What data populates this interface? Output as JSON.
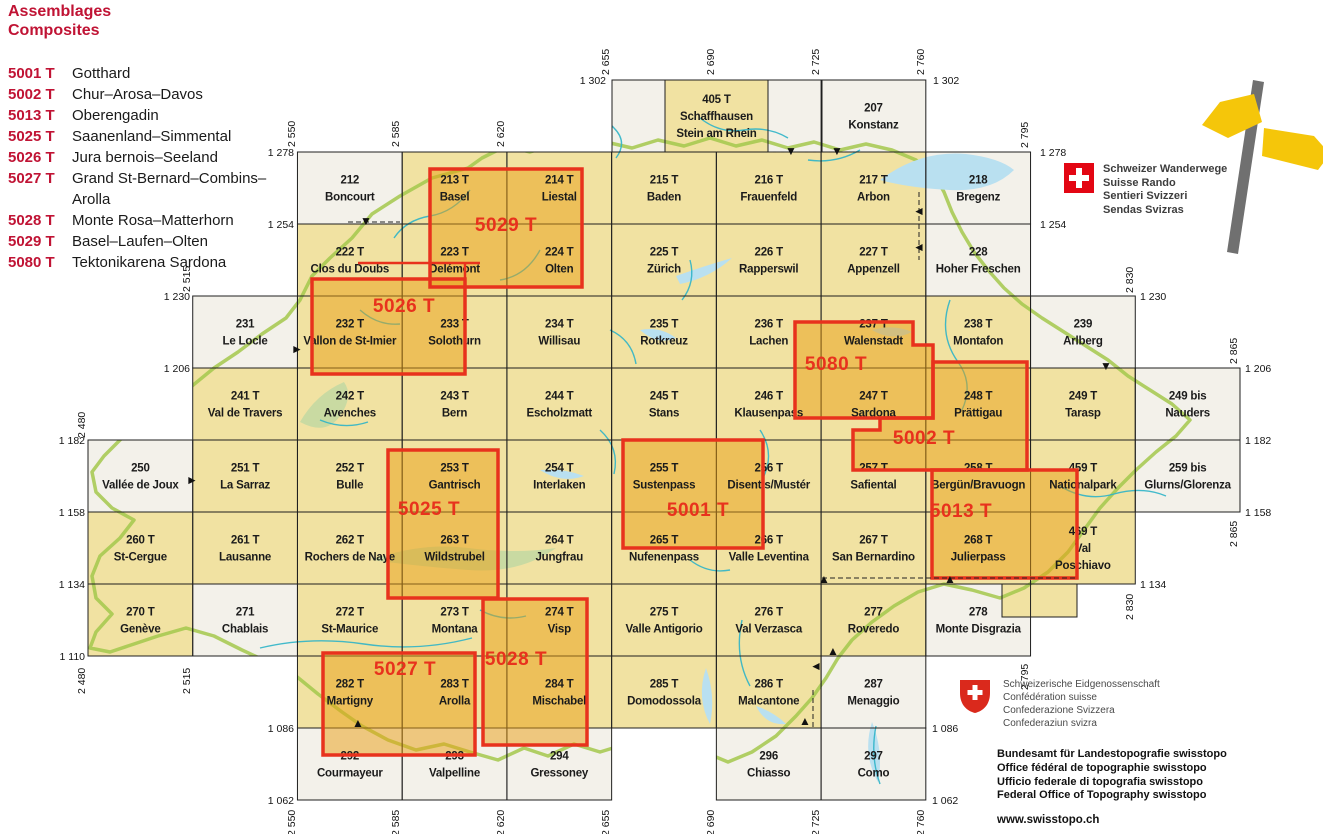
{
  "legend": {
    "title1": "Assemblages",
    "title2": "Composites",
    "items": [
      {
        "code": "5001 T",
        "name": "Gotthard"
      },
      {
        "code": "5002 T",
        "name": "Chur–Arosa–Davos"
      },
      {
        "code": "5013 T",
        "name": "Oberengadin"
      },
      {
        "code": "5025 T",
        "name": "Saanenland–Simmental"
      },
      {
        "code": "5026 T",
        "name": "Jura bernois–Seeland"
      },
      {
        "code": "5027 T",
        "name": "Grand St-Bernard–Combins– Arolla"
      },
      {
        "code": "5028 T",
        "name": "Monte Rosa–Matterhorn"
      },
      {
        "code": "5029 T",
        "name": "Basel–Laufen–Olten"
      },
      {
        "code": "5080 T",
        "name": "Tektonikarena Sardona"
      }
    ]
  },
  "wanderwege": {
    "lines": [
      "Schweizer Wanderwege",
      "Suisse Rando",
      "Sentieri Svizzeri",
      "Sendas Svizras"
    ]
  },
  "footer": {
    "confed_lines": [
      "Schweizerische Eidgenossenschaft",
      "Confédération suisse",
      "Confederazione Svizzera",
      "Confederaziun svizra"
    ],
    "office_lines": [
      "Bundesamt für Landestopografie swisstopo",
      "Office fédéral de topographie swisstopo",
      "Ufficio federale di topografia swisstopo",
      "Federal Office of Topography swisstopo"
    ],
    "website": "www.swisstopo.ch"
  },
  "map": {
    "colors": {
      "plain": "#f1e2a2",
      "foreign": "#f3f1ea",
      "highlight_fill": "rgba(234,158,18,0.5)",
      "composite_red": "#e8321d",
      "legend_red": "#c01334",
      "grid_line": "#1f1f1f",
      "river": "#2fb4c8",
      "border_trail": "#a3c84c",
      "lake_blue": "#b9e0f0",
      "lake_green": "#c9daa2"
    },
    "cells": [
      {
        "n": "",
        "m": [],
        "px": [
          612,
          80,
          53,
          72
        ],
        "t": "f"
      },
      {
        "n": "405 T",
        "m": [
          "Schaffhausen",
          "Stein am Rhein"
        ],
        "px": [
          665,
          80,
          103,
          72
        ],
        "t": "p"
      },
      {
        "n": "",
        "m": [],
        "px": [
          768,
          80,
          54,
          72
        ],
        "t": "f"
      },
      {
        "n": "207",
        "m": [
          "Konstanz"
        ],
        "e": 2725,
        "no": 1302,
        "t": "f"
      },
      {
        "n": "212",
        "m": [
          "Boncourt"
        ],
        "e": 2550,
        "no": 1278,
        "t": "f"
      },
      {
        "n": "213 T",
        "m": [
          "Basel"
        ],
        "e": 2585,
        "no": 1278,
        "t": "p"
      },
      {
        "n": "214 T",
        "m": [
          "Liestal"
        ],
        "e": 2620,
        "no": 1278,
        "t": "p"
      },
      {
        "n": "215 T",
        "m": [
          "Baden"
        ],
        "e": 2655,
        "no": 1278,
        "t": "p"
      },
      {
        "n": "216 T",
        "m": [
          "Frauenfeld"
        ],
        "e": 2690,
        "no": 1278,
        "t": "p"
      },
      {
        "n": "217 T",
        "m": [
          "Arbon"
        ],
        "e": 2725,
        "no": 1278,
        "t": "p"
      },
      {
        "n": "218",
        "m": [
          "Bregenz"
        ],
        "e": 2760,
        "no": 1278,
        "t": "f"
      },
      {
        "n": "222 T",
        "m": [
          "Clos du Doubs"
        ],
        "e": 2550,
        "no": 1254,
        "t": "p"
      },
      {
        "n": "223 T",
        "m": [
          "Delémont"
        ],
        "e": 2585,
        "no": 1254,
        "t": "p"
      },
      {
        "n": "224 T",
        "m": [
          "Olten"
        ],
        "e": 2620,
        "no": 1254,
        "t": "p"
      },
      {
        "n": "225 T",
        "m": [
          "Zürich"
        ],
        "e": 2655,
        "no": 1254,
        "t": "p"
      },
      {
        "n": "226 T",
        "m": [
          "Rapperswil"
        ],
        "e": 2690,
        "no": 1254,
        "t": "p"
      },
      {
        "n": "227 T",
        "m": [
          "Appenzell"
        ],
        "e": 2725,
        "no": 1254,
        "t": "p"
      },
      {
        "n": "228",
        "m": [
          "Hoher Freschen"
        ],
        "e": 2760,
        "no": 1254,
        "t": "f"
      },
      {
        "n": "231",
        "m": [
          "Le Locle"
        ],
        "e": 2515,
        "no": 1230,
        "t": "f"
      },
      {
        "n": "232 T",
        "m": [
          "Vallon de St-Imier"
        ],
        "e": 2550,
        "no": 1230,
        "t": "p"
      },
      {
        "n": "233 T",
        "m": [
          "Solothurn"
        ],
        "e": 2585,
        "no": 1230,
        "t": "p"
      },
      {
        "n": "234 T",
        "m": [
          "Willisau"
        ],
        "e": 2620,
        "no": 1230,
        "t": "p"
      },
      {
        "n": "235 T",
        "m": [
          "Rotkreuz"
        ],
        "e": 2655,
        "no": 1230,
        "t": "p"
      },
      {
        "n": "236 T",
        "m": [
          "Lachen"
        ],
        "e": 2690,
        "no": 1230,
        "t": "p"
      },
      {
        "n": "237 T",
        "m": [
          "Walenstadt"
        ],
        "e": 2725,
        "no": 1230,
        "t": "p"
      },
      {
        "n": "238 T",
        "m": [
          "Montafon"
        ],
        "e": 2760,
        "no": 1230,
        "t": "p"
      },
      {
        "n": "239",
        "m": [
          "Arlberg"
        ],
        "e": 2795,
        "no": 1230,
        "t": "f"
      },
      {
        "n": "241 T",
        "m": [
          "Val de Travers"
        ],
        "e": 2515,
        "no": 1206,
        "t": "p"
      },
      {
        "n": "242 T",
        "m": [
          "Avenches"
        ],
        "e": 2550,
        "no": 1206,
        "t": "p"
      },
      {
        "n": "243 T",
        "m": [
          "Bern"
        ],
        "e": 2585,
        "no": 1206,
        "t": "p"
      },
      {
        "n": "244 T",
        "m": [
          "Escholzmatt"
        ],
        "e": 2620,
        "no": 1206,
        "t": "p"
      },
      {
        "n": "245 T",
        "m": [
          "Stans"
        ],
        "e": 2655,
        "no": 1206,
        "t": "p"
      },
      {
        "n": "246 T",
        "m": [
          "Klausenpass"
        ],
        "e": 2690,
        "no": 1206,
        "t": "p"
      },
      {
        "n": "247 T",
        "m": [
          "Sardona"
        ],
        "e": 2725,
        "no": 1206,
        "t": "p"
      },
      {
        "n": "248 T",
        "m": [
          "Prättigau"
        ],
        "e": 2760,
        "no": 1206,
        "t": "p"
      },
      {
        "n": "249 T",
        "m": [
          "Tarasp"
        ],
        "e": 2795,
        "no": 1206,
        "t": "p"
      },
      {
        "n": "249 bis",
        "m": [
          "Nauders"
        ],
        "e": 2830,
        "no": 1206,
        "t": "f"
      },
      {
        "n": "250",
        "m": [
          "Vallée de Joux"
        ],
        "e": 2480,
        "no": 1182,
        "t": "f"
      },
      {
        "n": "251 T",
        "m": [
          "La Sarraz"
        ],
        "e": 2515,
        "no": 1182,
        "t": "p"
      },
      {
        "n": "252 T",
        "m": [
          "Bulle"
        ],
        "e": 2550,
        "no": 1182,
        "t": "p"
      },
      {
        "n": "253 T",
        "m": [
          "Gantrisch"
        ],
        "e": 2585,
        "no": 1182,
        "t": "p"
      },
      {
        "n": "254 T",
        "m": [
          "Interlaken"
        ],
        "e": 2620,
        "no": 1182,
        "t": "p"
      },
      {
        "n": "255 T",
        "m": [
          "Sustenpass"
        ],
        "e": 2655,
        "no": 1182,
        "t": "p"
      },
      {
        "n": "256 T",
        "m": [
          "Disentis/Mustér"
        ],
        "e": 2690,
        "no": 1182,
        "t": "p"
      },
      {
        "n": "257 T",
        "m": [
          "Safiental"
        ],
        "e": 2725,
        "no": 1182,
        "t": "p"
      },
      {
        "n": "258 T",
        "m": [
          "Bergün/Bravuogn"
        ],
        "e": 2760,
        "no": 1182,
        "t": "p"
      },
      {
        "n": "459 T",
        "m": [
          "Nationalpark"
        ],
        "e": 2795,
        "no": 1182,
        "t": "p"
      },
      {
        "n": "259 bis",
        "m": [
          "Glurns/Glorenza"
        ],
        "e": 2830,
        "no": 1182,
        "t": "f"
      },
      {
        "n": "260 T",
        "m": [
          "St-Cergue"
        ],
        "e": 2480,
        "no": 1158,
        "t": "p"
      },
      {
        "n": "261 T",
        "m": [
          "Lausanne"
        ],
        "e": 2515,
        "no": 1158,
        "t": "p"
      },
      {
        "n": "262 T",
        "m": [
          "Rochers de Naye"
        ],
        "e": 2550,
        "no": 1158,
        "t": "p"
      },
      {
        "n": "263 T",
        "m": [
          "Wildstrubel"
        ],
        "e": 2585,
        "no": 1158,
        "t": "p"
      },
      {
        "n": "264 T",
        "m": [
          "Jungfrau"
        ],
        "e": 2620,
        "no": 1158,
        "t": "p"
      },
      {
        "n": "265 T",
        "m": [
          "Nufenenpass"
        ],
        "e": 2655,
        "no": 1158,
        "t": "p"
      },
      {
        "n": "266 T",
        "m": [
          "Valle Leventina"
        ],
        "e": 2690,
        "no": 1158,
        "t": "p"
      },
      {
        "n": "267 T",
        "m": [
          "San Bernardino"
        ],
        "e": 2725,
        "no": 1158,
        "t": "p"
      },
      {
        "n": "268 T",
        "m": [
          "Julierpass"
        ],
        "e": 2760,
        "no": 1158,
        "t": "p"
      },
      {
        "n": "469 T",
        "m": [
          "Val",
          "Poschiavo"
        ],
        "e": 2795,
        "no": 1158,
        "t": "p"
      },
      {
        "n": "270 T",
        "m": [
          "Genève"
        ],
        "e": 2480,
        "no": 1134,
        "t": "p"
      },
      {
        "n": "271",
        "m": [
          "Chablais"
        ],
        "e": 2515,
        "no": 1134,
        "t": "f"
      },
      {
        "n": "272 T",
        "m": [
          "St-Maurice"
        ],
        "e": 2550,
        "no": 1134,
        "t": "p"
      },
      {
        "n": "273 T",
        "m": [
          "Montana"
        ],
        "e": 2585,
        "no": 1134,
        "t": "p"
      },
      {
        "n": "274 T",
        "m": [
          "Visp"
        ],
        "e": 2620,
        "no": 1134,
        "t": "p"
      },
      {
        "n": "275 T",
        "m": [
          "Valle Antigorio"
        ],
        "e": 2655,
        "no": 1134,
        "t": "p"
      },
      {
        "n": "276 T",
        "m": [
          "Val Verzasca"
        ],
        "e": 2690,
        "no": 1134,
        "t": "p"
      },
      {
        "n": "277",
        "m": [
          "Roveredo"
        ],
        "e": 2725,
        "no": 1134,
        "t": "p"
      },
      {
        "n": "278",
        "m": [
          "Monte Disgrazia"
        ],
        "e": 2760,
        "no": 1134,
        "t": "f"
      },
      {
        "n": "282 T",
        "m": [
          "Martigny"
        ],
        "e": 2550,
        "no": 1110,
        "t": "p"
      },
      {
        "n": "283 T",
        "m": [
          "Arolla"
        ],
        "e": 2585,
        "no": 1110,
        "t": "p"
      },
      {
        "n": "284 T",
        "m": [
          "Mischabel"
        ],
        "e": 2620,
        "no": 1110,
        "t": "p"
      },
      {
        "n": "285 T",
        "m": [
          "Domodossola"
        ],
        "e": 2655,
        "no": 1110,
        "t": "p"
      },
      {
        "n": "286 T",
        "m": [
          "Malcantone"
        ],
        "e": 2690,
        "no": 1110,
        "t": "p"
      },
      {
        "n": "287",
        "m": [
          "Menaggio"
        ],
        "e": 2725,
        "no": 1110,
        "t": "f"
      },
      {
        "n": "292",
        "m": [
          "Courmayeur"
        ],
        "e": 2550,
        "no": 1086,
        "t": "f"
      },
      {
        "n": "293",
        "m": [
          "Valpelline"
        ],
        "e": 2585,
        "no": 1086,
        "t": "f"
      },
      {
        "n": "294",
        "m": [
          "Gressoney"
        ],
        "e": 2620,
        "no": 1086,
        "t": "f"
      },
      {
        "n": "296",
        "m": [
          "Chiasso"
        ],
        "e": 2690,
        "no": 1086,
        "t": "f"
      },
      {
        "n": "297",
        "m": [
          "Como"
        ],
        "e": 2725,
        "no": 1086,
        "t": "f"
      },
      {
        "n": "",
        "m": [],
        "px": [
          1002,
          584,
          75,
          33
        ],
        "t": "p"
      }
    ],
    "composites": [
      {
        "code": "5029 T",
        "x": 506,
        "y": 231,
        "d": "M430 169 H582 V287 H430 Z"
      },
      {
        "code": "5026 T",
        "x": 404,
        "y": 312,
        "d": "M312 279 H465 V374 H312 Z"
      },
      {
        "code": "5080 T",
        "x": 836,
        "y": 370,
        "d": "M795 322 H913 V345 H933 V418 H795 Z"
      },
      {
        "code": "5002 T",
        "x": 924,
        "y": 444,
        "d": "M933 362 H1027 V470 H853 V430 H880 V418 H933 Z"
      },
      {
        "code": "5025 T",
        "x": 429,
        "y": 515,
        "d": "M388 450 H498 V598 H388 Z"
      },
      {
        "code": "5001 T",
        "x": 698,
        "y": 516,
        "d": "M623 440 H763 V548 H623 Z"
      },
      {
        "code": "5013 T",
        "x": 961,
        "y": 517,
        "d": "M932 470 H1077 V578 H932 Z"
      },
      {
        "code": "5027 T",
        "x": 405,
        "y": 675,
        "d": "M323 653 H475 V755 H323 Z"
      },
      {
        "code": "5028 T",
        "x": 516,
        "y": 665,
        "d": "M483 599 H587 V745 H483 Z"
      }
    ],
    "connectors": [
      "M358 263 H480",
      "M465 263 V279"
    ],
    "markers": [
      [
        "▼",
        791,
        151
      ],
      [
        "▼",
        837,
        151
      ],
      [
        "▼",
        366,
        221
      ],
      [
        "▼",
        1106,
        366
      ],
      [
        "◄",
        919,
        211
      ],
      [
        "◄",
        919,
        247
      ],
      [
        "◄",
        816,
        666
      ],
      [
        "►",
        297,
        349
      ],
      [
        "►",
        192,
        480
      ],
      [
        "▲",
        824,
        579
      ],
      [
        "▲",
        950,
        579
      ],
      [
        "▲",
        833,
        651
      ],
      [
        "▲",
        805,
        721
      ],
      [
        "▲",
        358,
        723
      ]
    ],
    "dashes": [
      [
        768,
        152,
        860,
        152
      ],
      [
        919,
        192,
        919,
        260
      ],
      [
        348,
        222,
        400,
        222
      ],
      [
        822,
        578,
        1077,
        578
      ],
      [
        813,
        690,
        813,
        727
      ]
    ],
    "axis_h": [
      [
        606,
        84,
        "1 302",
        "end"
      ],
      [
        933,
        84,
        "1 302",
        "start"
      ],
      [
        294,
        156,
        "1 278",
        "end"
      ],
      [
        1040,
        156,
        "1 278",
        "start"
      ],
      [
        294,
        228,
        "1 254",
        "end"
      ],
      [
        1040,
        228,
        "1 254",
        "start"
      ],
      [
        190,
        300,
        "1 230",
        "end"
      ],
      [
        1140,
        300,
        "1 230",
        "start"
      ],
      [
        190,
        372,
        "1 206",
        "end"
      ],
      [
        1245,
        372,
        "1 206",
        "start"
      ],
      [
        85,
        444,
        "1 182",
        "end"
      ],
      [
        1245,
        444,
        "1 182",
        "start"
      ],
      [
        85,
        516,
        "1 158",
        "end"
      ],
      [
        1245,
        516,
        "1 158",
        "start"
      ],
      [
        85,
        588,
        "1 134",
        "end"
      ],
      [
        1140,
        588,
        "1 134",
        "start"
      ],
      [
        85,
        660,
        "1 110",
        "end"
      ],
      [
        294,
        732,
        "1 086",
        "end"
      ],
      [
        932,
        732,
        "1 086",
        "start"
      ],
      [
        294,
        804,
        "1 062",
        "end"
      ],
      [
        932,
        804,
        "1 062",
        "start"
      ]
    ],
    "axis_v": [
      [
        295,
        147,
        "2 550"
      ],
      [
        399,
        147,
        "2 585"
      ],
      [
        504,
        147,
        "2 620"
      ],
      [
        609,
        75,
        "2 655"
      ],
      [
        714,
        75,
        "2 690"
      ],
      [
        819,
        75,
        "2 725"
      ],
      [
        924,
        75,
        "2 760"
      ],
      [
        1028,
        148,
        "2 795"
      ],
      [
        1133,
        293,
        "2 830"
      ],
      [
        1237,
        364,
        "2 865"
      ],
      [
        190,
        292,
        "2 515"
      ],
      [
        85,
        438,
        "2 480"
      ],
      [
        295,
        836,
        "2 550"
      ],
      [
        399,
        836,
        "2 585"
      ],
      [
        504,
        836,
        "2 620"
      ],
      [
        609,
        836,
        "2 655"
      ],
      [
        714,
        836,
        "2 690"
      ],
      [
        819,
        836,
        "2 725"
      ],
      [
        924,
        836,
        "2 760"
      ],
      [
        85,
        694,
        "2 480"
      ],
      [
        190,
        694,
        "2 515"
      ],
      [
        1028,
        690,
        "2 795"
      ],
      [
        1133,
        620,
        "2 830"
      ],
      [
        1237,
        547,
        "2 865"
      ]
    ]
  }
}
